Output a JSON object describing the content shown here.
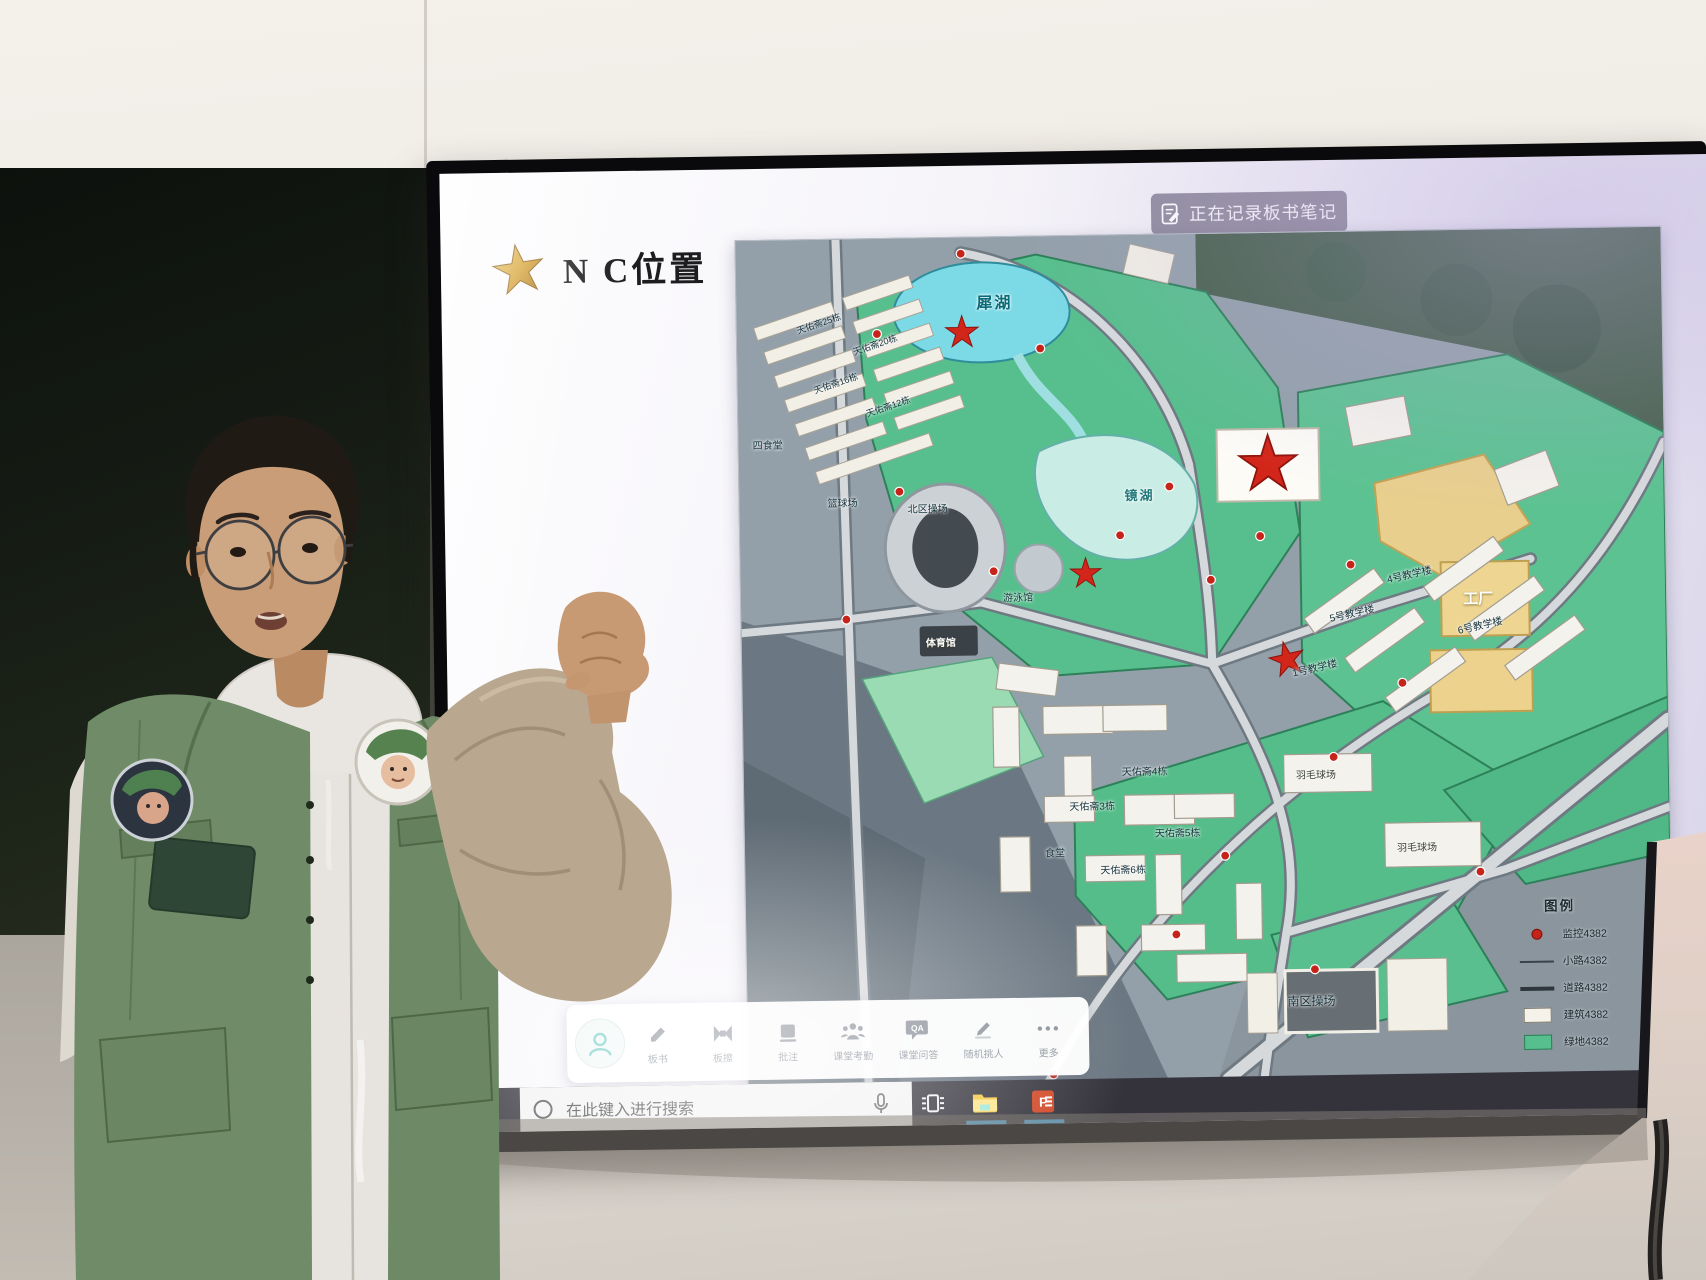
{
  "screen": {
    "notification": {
      "icon": "note-edit-icon",
      "text": "正在记录板书笔记"
    },
    "slide": {
      "star_icon": "gold-star-icon",
      "title": "N  C位置"
    },
    "assistant_toolbar": {
      "avatar_icon": "person-icon",
      "items": [
        {
          "icon": "marker-icon",
          "label": "板书"
        },
        {
          "icon": "eraser-icon",
          "label": "板擦"
        },
        {
          "icon": "board-icon",
          "label": "批注"
        },
        {
          "icon": "people-icon",
          "label": "课堂考勤"
        },
        {
          "icon": "qa-icon",
          "label": "课堂问答"
        },
        {
          "icon": "pencil-icon",
          "label": "随机挑人"
        },
        {
          "icon": "more-icon",
          "label": "更多"
        }
      ]
    },
    "taskbar": {
      "search": {
        "icon": "search-circle-icon",
        "placeholder": "在此键入进行搜索"
      },
      "mic_icon": "microphone-icon",
      "app_icons": [
        "task-view-icon",
        "file-explorer-icon",
        "powerpoint-icon"
      ]
    }
  },
  "map": {
    "labels": [
      {
        "text": "犀湖"
      },
      {
        "text": "镜湖"
      },
      {
        "text": "篮球场"
      },
      {
        "text": "北区操场"
      },
      {
        "text": "游泳馆"
      },
      {
        "text": "体育馆"
      },
      {
        "text": "四食堂"
      },
      {
        "text": "天佑斋25栋"
      },
      {
        "text": "天佑斋20栋"
      },
      {
        "text": "天佑斋16栋"
      },
      {
        "text": "天佑斋12栋"
      },
      {
        "text": "4号教学楼"
      },
      {
        "text": "5号教学楼"
      },
      {
        "text": "6号教学楼"
      },
      {
        "text": "1号教学楼"
      },
      {
        "text": "天佑斋4栋"
      },
      {
        "text": "天佑斋3栋"
      },
      {
        "text": "天佑斋5栋"
      },
      {
        "text": "天佑斋6栋"
      },
      {
        "text": "食堂"
      },
      {
        "text": "羽毛球场"
      },
      {
        "text": "羽毛球场"
      },
      {
        "text": "工厂"
      },
      {
        "text": "南区操场"
      }
    ],
    "legend": {
      "title": "图例",
      "rows": [
        {
          "swatch": "camera-dot",
          "text": "监控4382"
        },
        {
          "swatch": "thin-line",
          "text": "小路4382"
        },
        {
          "swatch": "thick-line",
          "text": "道路4382"
        },
        {
          "swatch": "building-box",
          "text": "建筑4382"
        },
        {
          "swatch": "green-box",
          "text": "绿地4382"
        }
      ]
    },
    "colors": {
      "lawn": "#57bf8d",
      "lake": "#7cd9e6",
      "building": "#f4f2ec",
      "factory_zone": "#eed591",
      "star_red": "#d3261a"
    }
  }
}
